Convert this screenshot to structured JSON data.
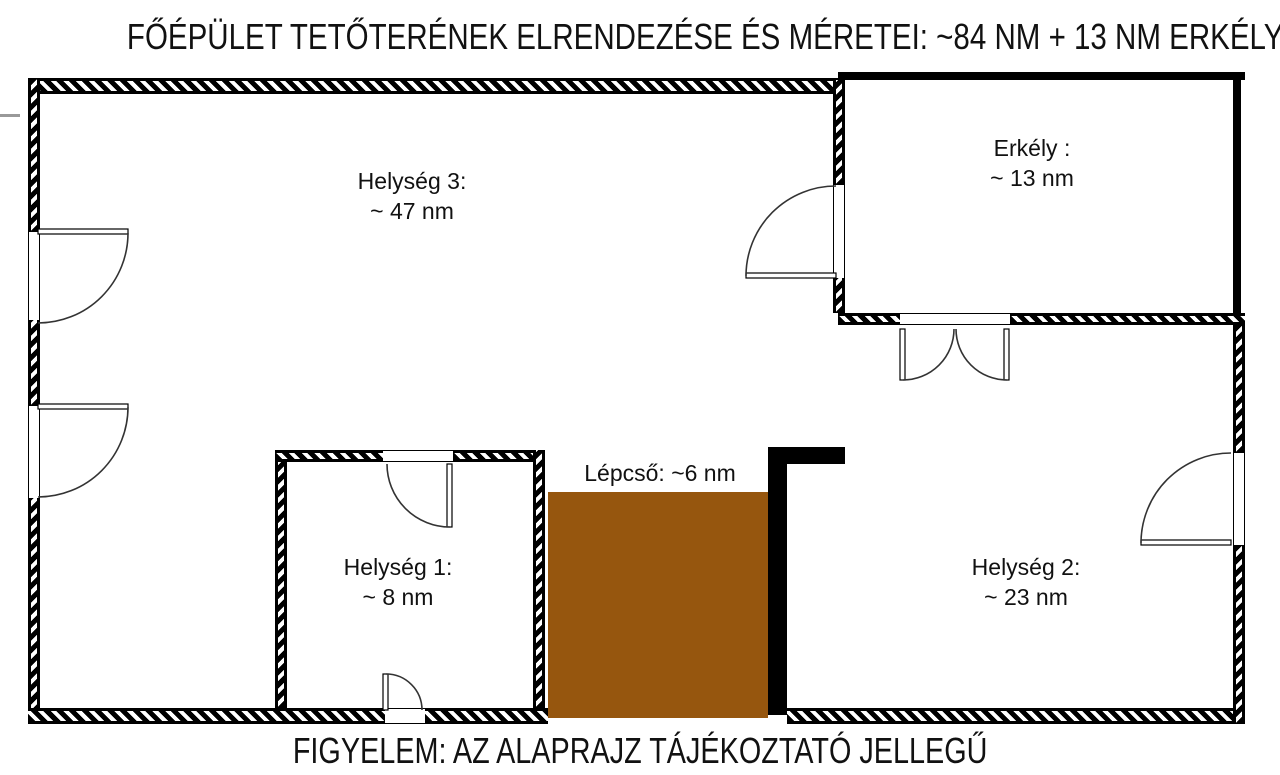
{
  "title": "FŐÉPÜLET TETŐTERÉNEK ELRENDEZÉSE ÉS MÉRETEI: ~84 NM + 13 NM ERKÉLY",
  "footer": "FIGYELEM: AZ ALAPRAJZ TÁJÉKOZTATÓ JELLEGŰ",
  "rooms": {
    "helyseg3": {
      "name": "Helység 3:",
      "area": "~ 47 nm"
    },
    "erkely": {
      "name": "Erkély :",
      "area": "~ 13 nm"
    },
    "helyseg1": {
      "name": "Helység 1:",
      "area": "~ 8 nm"
    },
    "helyseg2": {
      "name": "Helység 2:",
      "area": "~ 23 nm"
    },
    "stairs": {
      "label": "Lépcső: ~6 nm"
    }
  },
  "colors": {
    "wall": "#000000",
    "stairs_fill": "#96560E",
    "background": "#FFFFFF"
  }
}
